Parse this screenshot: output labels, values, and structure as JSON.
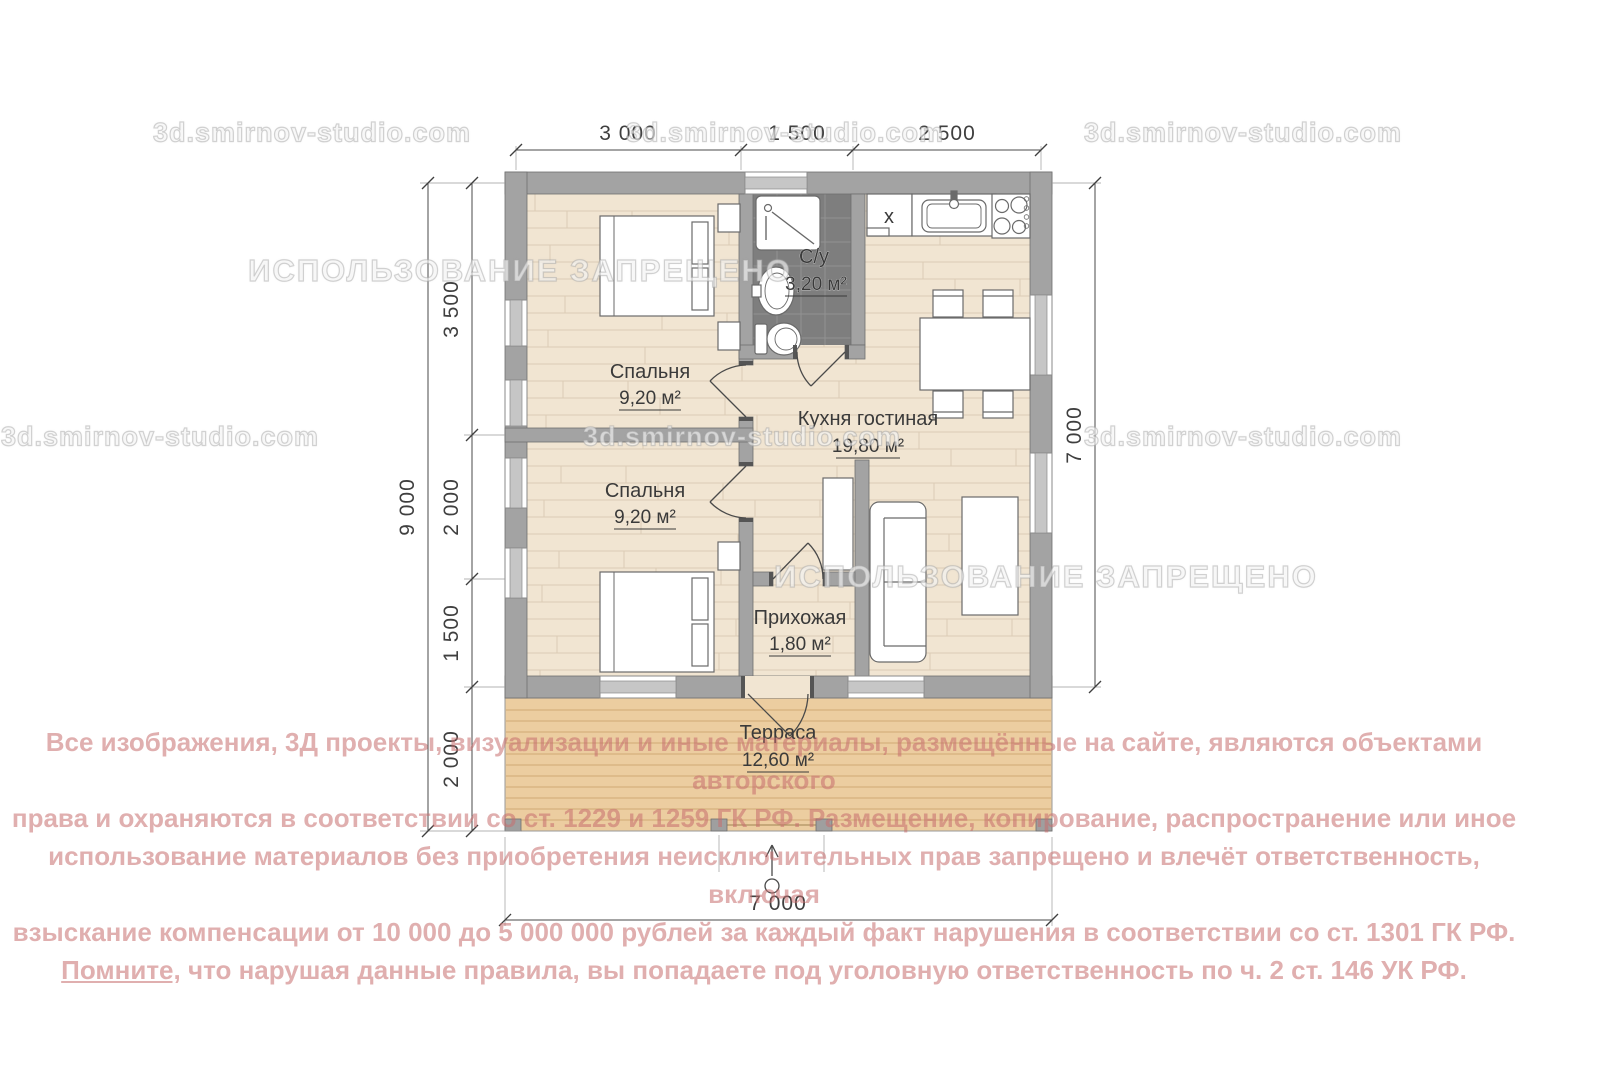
{
  "watermarks": {
    "site": "3d.smirnov-studio.com",
    "forbidden": "ИСПОЛЬЗОВАНИЕ ЗАПРЕЩЕНО"
  },
  "plan": {
    "rooms": [
      {
        "id": "bedroom-1",
        "name": "Спальня",
        "area": "9,20 м²"
      },
      {
        "id": "bedroom-2",
        "name": "Спальня",
        "area": "9,20 м²"
      },
      {
        "id": "bathroom",
        "name": "С/у",
        "area": "3,20 м²"
      },
      {
        "id": "kitchen-living",
        "name": "Кухня гостиная",
        "area": "19,80 м²"
      },
      {
        "id": "hallway",
        "name": "Прихожая",
        "area": "1,80 м²"
      },
      {
        "id": "terrace",
        "name": "Терраса",
        "area": "12,60 м²"
      }
    ],
    "fridge_symbol": "x",
    "dimensions": {
      "top": [
        "3 000",
        "1 500",
        "2 500"
      ],
      "left_segments": [
        "3 500",
        "2 000",
        "1 500",
        "2 000"
      ],
      "left_total": "9 000",
      "right": "7 000",
      "bottom": "7 000"
    },
    "colors": {
      "floor_wood": "#f1e5d2",
      "terrace_wood": "#eccda0",
      "wall_gray": "#a3a3a3",
      "bathroom_tile": "#7e7e7e",
      "copyright_pink": "#c66e6e"
    }
  },
  "copyright": {
    "lines": [
      "Все изображения, 3Д проекты, визуализации и иные материалы, размещённые на сайте, являются объектами авторского",
      "права и охраняются в соответствии со ст. 1229 и 1259 ГК РФ. Размещение, копирование, распространение или иное",
      "использование материалов без приобретения неисключительных прав запрещено и влечёт ответственность, включая",
      "взыскание компенсации от 10 000 до 5 000 000 рублей за каждый факт нарушения в соответствии со ст. 1301 ГК РФ."
    ],
    "line5": {
      "underlined": "Помните,",
      "rest": " что нарушая данные правила, вы попадаете под уголовную ответственность по ч. 2 ст. 146 УК РФ."
    }
  }
}
